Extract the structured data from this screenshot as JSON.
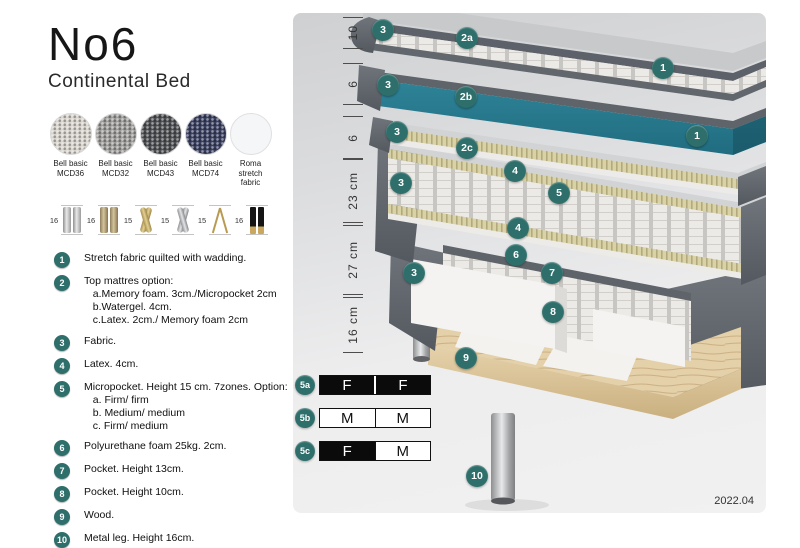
{
  "header": {
    "title": "No6",
    "subtitle": "Continental Bed"
  },
  "accent": "#2e6f6b",
  "fabrics": [
    {
      "label": "Bell basic\nMCD36",
      "color": "#d8d4cd",
      "cls": "woven"
    },
    {
      "label": "Bell basic\nMCD32",
      "color": "#9e9d9b",
      "cls": "woven"
    },
    {
      "label": "Bell basic\nMCD43",
      "color": "#4f5053",
      "cls": "woven"
    },
    {
      "label": "Bell basic\nMCD74",
      "color": "#3b4060",
      "cls": "woven"
    },
    {
      "label": "Roma\nstretch fabric",
      "color": "#f5f6f7",
      "cls": "plain"
    }
  ],
  "legs": [
    {
      "height": "16",
      "type": "cyl-silver"
    },
    {
      "height": "16",
      "type": "cyl-bronze"
    },
    {
      "height": "15",
      "type": "twist-gold"
    },
    {
      "height": "15",
      "type": "twist-silver"
    },
    {
      "height": "15",
      "type": "hairpin"
    },
    {
      "height": "16",
      "type": "black-gold"
    }
  ],
  "features": [
    {
      "num": "1",
      "text": "Stretch fabric quilted with wadding."
    },
    {
      "num": "2",
      "text": "Top mattres option:\n   a.Memory foam. 3cm./Micropocket 2cm\n   b.Watergel. 4cm.\n   c.Latex. 2cm./ Memory foam 2cm"
    },
    {
      "num": "3",
      "text": "Fabric."
    },
    {
      "num": "4",
      "text": "Latex. 4cm."
    },
    {
      "num": "5",
      "text": "Micropocket. Height 15 cm. 7zones. Option:\n   a. Firm/ firm\n   b. Medium/ medium\n   c. Firm/ medium"
    },
    {
      "num": "6",
      "text": "Polyurethane foam 25kg. 2cm."
    },
    {
      "num": "7",
      "text": "Pocket. Height 13cm."
    },
    {
      "num": "8",
      "text": "Pocket. Height 10cm."
    },
    {
      "num": "9",
      "text": "Wood."
    },
    {
      "num": "10",
      "text": "Metal leg. Height 16cm."
    }
  ],
  "diagram": {
    "version": "2022.04",
    "dimensions": [
      {
        "t": "10",
        "top": 4,
        "h": 32
      },
      {
        "t": "6",
        "top": 50,
        "h": 42
      },
      {
        "t": "6",
        "top": 103,
        "h": 43
      },
      {
        "t": "23 cm",
        "top": 146,
        "h": 64
      },
      {
        "t": "27 cm",
        "top": 212,
        "h": 70
      },
      {
        "t": "16 cm",
        "top": 284,
        "h": 56
      }
    ],
    "markers": [
      {
        "t": "3",
        "x": 79,
        "y": 6
      },
      {
        "t": "2a",
        "x": 163,
        "y": 14
      },
      {
        "t": "1",
        "x": 359,
        "y": 44
      },
      {
        "t": "3",
        "x": 84,
        "y": 61
      },
      {
        "t": "2b",
        "x": 162,
        "y": 73
      },
      {
        "t": "3",
        "x": 93,
        "y": 108
      },
      {
        "t": "2c",
        "x": 163,
        "y": 124
      },
      {
        "t": "1",
        "x": 393,
        "y": 112
      },
      {
        "t": "3",
        "x": 97,
        "y": 159
      },
      {
        "t": "4",
        "x": 211,
        "y": 147
      },
      {
        "t": "5",
        "x": 255,
        "y": 169
      },
      {
        "t": "4",
        "x": 214,
        "y": 204
      },
      {
        "t": "6",
        "x": 212,
        "y": 231
      },
      {
        "t": "3",
        "x": 110,
        "y": 249
      },
      {
        "t": "7",
        "x": 248,
        "y": 249
      },
      {
        "t": "8",
        "x": 249,
        "y": 288
      },
      {
        "t": "9",
        "x": 162,
        "y": 334
      },
      {
        "t": "10",
        "x": 173,
        "y": 452
      }
    ],
    "firmness": {
      "rows": [
        {
          "label": "5a",
          "cells": [
            {
              "t": "F"
            },
            {
              "t": "F"
            }
          ]
        },
        {
          "label": "5b",
          "cells": [
            {
              "t": "M"
            },
            {
              "t": "M"
            }
          ]
        },
        {
          "label": "5c",
          "cells": [
            {
              "t": "F"
            },
            {
              "t": "M"
            }
          ]
        }
      ]
    }
  }
}
